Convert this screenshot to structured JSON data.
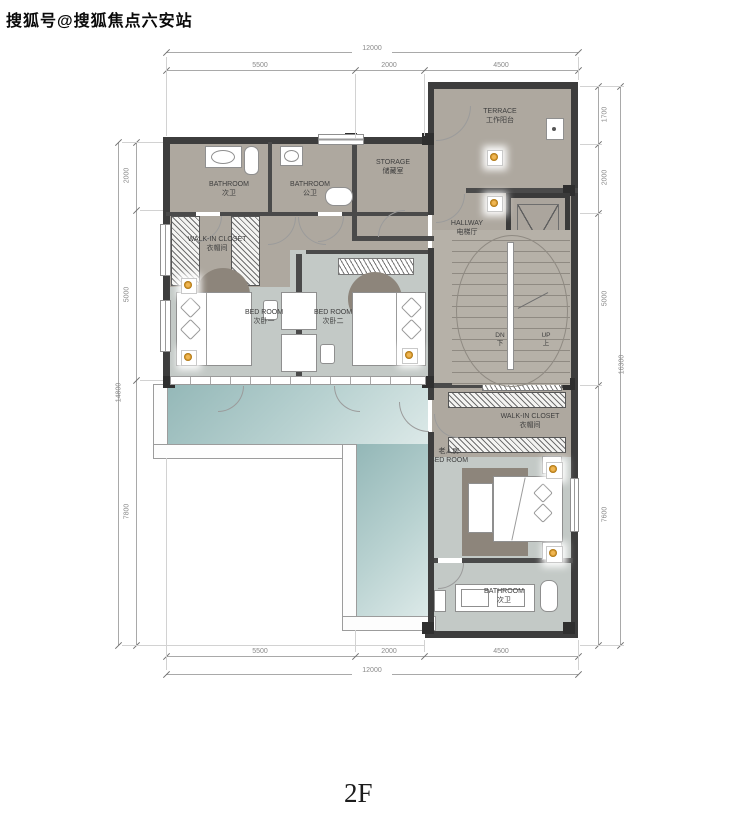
{
  "watermark": {
    "text": "搜狐号@搜狐焦点六安站"
  },
  "floor_label": "2F",
  "rooms": {
    "bathroom_top1": {
      "en": "BATHROOM",
      "zh": "次卫"
    },
    "bathroom_top2": {
      "en": "BATHROOM",
      "zh": "公卫"
    },
    "storage": {
      "en": "STORAGE",
      "zh": "储藏室"
    },
    "terrace": {
      "en": "TERRACE",
      "zh": "工作阳台"
    },
    "hallway": {
      "en": "HALLWAY",
      "zh": "电梯厅"
    },
    "walkin_closet_upper": {
      "en": "WALK-IN CLOSET",
      "zh": "衣帽间"
    },
    "bedroom1": {
      "en": "BED ROOM",
      "zh": "次卧一"
    },
    "bedroom2": {
      "en": "BED ROOM",
      "zh": "次卧二"
    },
    "walkin_closet_right": {
      "en": "WALK-IN CLOSET",
      "zh": "衣帽间"
    },
    "elder_bedroom": {
      "zh": "老人房",
      "en": "BED ROOM"
    },
    "bathroom_bottom": {
      "en": "BATHROOM",
      "zh": "次卫"
    }
  },
  "stairs": {
    "down_en": "DN",
    "down_zh": "下",
    "up_en": "UP",
    "up_zh": "上"
  },
  "dimensions": {
    "top": {
      "total": "12000",
      "segments": [
        "5500",
        "2000",
        "4500"
      ]
    },
    "bottom": {
      "total": "12000",
      "segments": [
        "5500",
        "2000",
        "4500"
      ]
    },
    "left": {
      "total": "14800",
      "segments": [
        "2000",
        "5000",
        "7800"
      ]
    },
    "right": {
      "total": "16300",
      "segments": [
        "1700",
        "2000",
        "5000",
        "7600"
      ]
    }
  },
  "colors": {
    "wall": "#3d3d3d",
    "floor_warm": "#aea89f",
    "floor_cool": "#c3c9c6",
    "terrace_teal": "#93b7b7",
    "light_accent": "#b97d14"
  }
}
